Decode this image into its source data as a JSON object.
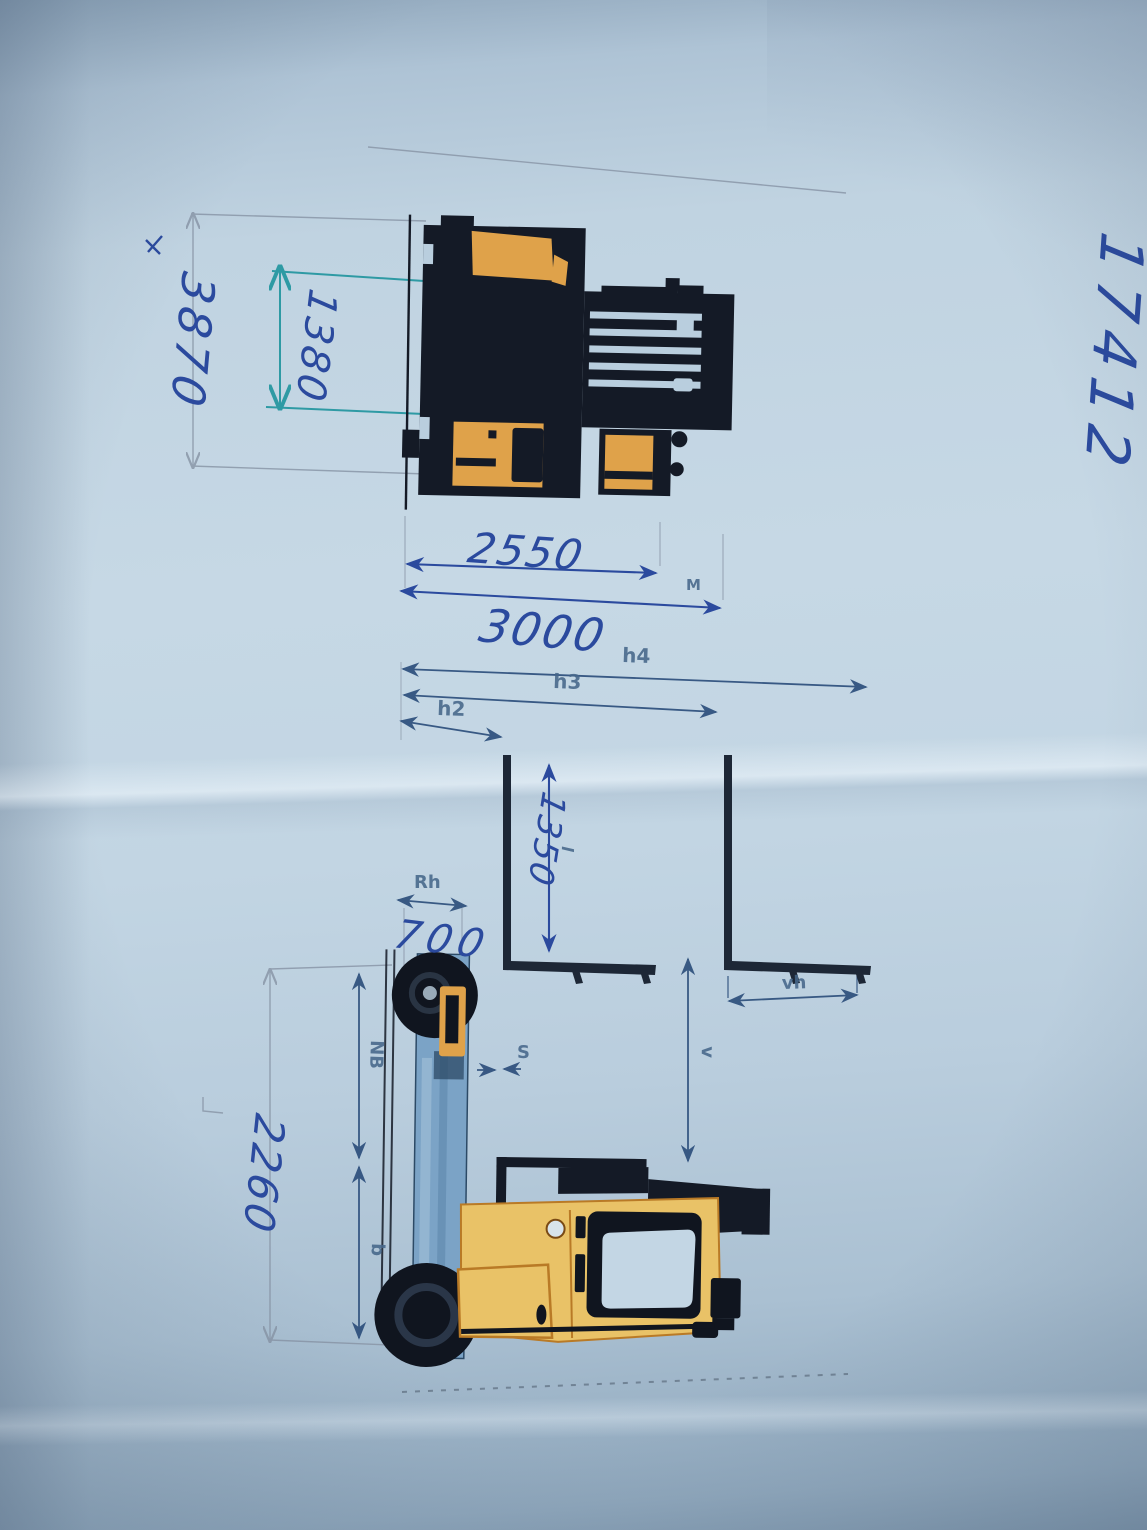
{
  "handwritten": {
    "ref_number": "17412",
    "dim_3870": "3870",
    "dim_1380": "1380",
    "dim_2550": "2550",
    "dim_3000": "3000",
    "dim_1350": "1350",
    "dim_700": "700",
    "dim_2260": "2260"
  },
  "printed_labels": {
    "m": "M",
    "h4": "h4",
    "h3": "h3",
    "h2": "h2",
    "rh": "Rh",
    "nb": "NB",
    "b": "b",
    "vh": "vh",
    "v": "v",
    "s": "S",
    "l": "l"
  },
  "colors": {
    "paper_blue": "#c6d8e5",
    "pen_blue": "#2b4a9e",
    "teal_pen": "#2e9aa4",
    "printed_line": "#2d4f7c",
    "pencil": "#8a97a8",
    "machine_dark": "#141a26",
    "machine_orange": "#dfa24a",
    "body_yellow": "#e9c267",
    "mast_blue": "#7ba3c6"
  }
}
